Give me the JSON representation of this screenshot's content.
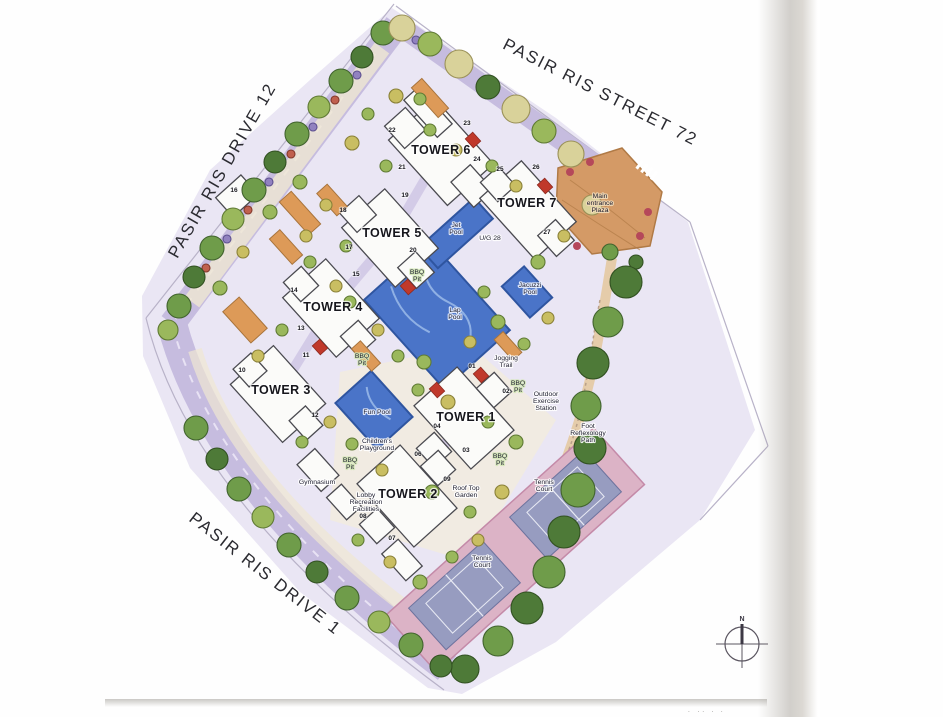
{
  "map": {
    "streets": [
      {
        "name": "PASIR RIS DRIVE 12",
        "x": 227,
        "y": 173,
        "angle": -60
      },
      {
        "name": "PASIR RIS STREET 72",
        "x": 598,
        "y": 97,
        "angle": 27
      },
      {
        "name": "PASIR RIS DRIVE 1",
        "x": 262,
        "y": 578,
        "angle": 38
      }
    ],
    "towers": [
      {
        "name": "TOWER 1",
        "x": 466,
        "y": 421
      },
      {
        "name": "TOWER 2",
        "x": 408,
        "y": 498
      },
      {
        "name": "TOWER 3",
        "x": 281,
        "y": 394
      },
      {
        "name": "TOWER 4",
        "x": 333,
        "y": 311
      },
      {
        "name": "TOWER 5",
        "x": 392,
        "y": 237
      },
      {
        "name": "TOWER 6",
        "x": 441,
        "y": 154
      },
      {
        "name": "TOWER 7",
        "x": 527,
        "y": 207
      }
    ],
    "amenities": [
      {
        "lines": [
          "Main",
          "entrance",
          "Plaza"
        ],
        "x": 600,
        "y": 198,
        "tint": "plaza"
      },
      {
        "lines": [
          "Jet",
          "Pool"
        ],
        "x": 456,
        "y": 227,
        "tint": "water"
      },
      {
        "lines": [
          "U/G 28"
        ],
        "x": 490,
        "y": 240,
        "tint": "plain"
      },
      {
        "lines": [
          "Lap",
          "Pool"
        ],
        "x": 455,
        "y": 312,
        "tint": "water"
      },
      {
        "lines": [
          "Jacuzzi",
          "Pool"
        ],
        "x": 530,
        "y": 287,
        "tint": "water"
      },
      {
        "lines": [
          "Fun Pool"
        ],
        "x": 377,
        "y": 414,
        "tint": "water"
      },
      {
        "lines": [
          "BBQ",
          "Pit"
        ],
        "x": 417,
        "y": 274,
        "tint": "green"
      },
      {
        "lines": [
          "BBQ",
          "Pit"
        ],
        "x": 362,
        "y": 358,
        "tint": "green"
      },
      {
        "lines": [
          "BBQ",
          "Pit"
        ],
        "x": 518,
        "y": 385,
        "tint": "green"
      },
      {
        "lines": [
          "BBQ",
          "Pit"
        ],
        "x": 500,
        "y": 458,
        "tint": "green"
      },
      {
        "lines": [
          "BBQ",
          "Pit"
        ],
        "x": 350,
        "y": 462,
        "tint": "green"
      },
      {
        "lines": [
          "Jogging",
          "Trail"
        ],
        "x": 506,
        "y": 360,
        "tint": "plain"
      },
      {
        "lines": [
          "Outdoor",
          "Exercise",
          "Station"
        ],
        "x": 546,
        "y": 396,
        "tint": "plain"
      },
      {
        "lines": [
          "Foot",
          "Reflexology",
          "Path"
        ],
        "x": 588,
        "y": 428,
        "tint": "plain"
      },
      {
        "lines": [
          "Tennis",
          "Court"
        ],
        "x": 544,
        "y": 484,
        "tint": "plain"
      },
      {
        "lines": [
          "Tennis",
          "Court"
        ],
        "x": 482,
        "y": 560,
        "tint": "plain"
      },
      {
        "lines": [
          "Roof Top",
          "Garden"
        ],
        "x": 466,
        "y": 490,
        "tint": "plain"
      },
      {
        "lines": [
          "Children's",
          "Playground"
        ],
        "x": 377,
        "y": 443,
        "tint": "plain"
      },
      {
        "lines": [
          "Gymnasium"
        ],
        "x": 317,
        "y": 484,
        "tint": "plain"
      },
      {
        "lines": [
          "Lobby",
          "Recreation",
          "Facilities"
        ],
        "x": 366,
        "y": 497,
        "tint": "plain"
      }
    ],
    "unit_numbers": [
      {
        "n": "01",
        "x": 472,
        "y": 368
      },
      {
        "n": "02",
        "x": 506,
        "y": 393
      },
      {
        "n": "03",
        "x": 466,
        "y": 452
      },
      {
        "n": "04",
        "x": 437,
        "y": 428
      },
      {
        "n": "06",
        "x": 418,
        "y": 456
      },
      {
        "n": "07",
        "x": 392,
        "y": 540
      },
      {
        "n": "08",
        "x": 363,
        "y": 518
      },
      {
        "n": "09",
        "x": 447,
        "y": 481
      },
      {
        "n": "10",
        "x": 242,
        "y": 372
      },
      {
        "n": "11",
        "x": 306,
        "y": 357
      },
      {
        "n": "12",
        "x": 315,
        "y": 417
      },
      {
        "n": "13",
        "x": 301,
        "y": 330
      },
      {
        "n": "14",
        "x": 294,
        "y": 292
      },
      {
        "n": "15",
        "x": 356,
        "y": 276
      },
      {
        "n": "16",
        "x": 234,
        "y": 192
      },
      {
        "n": "17",
        "x": 349,
        "y": 249
      },
      {
        "n": "18",
        "x": 343,
        "y": 212
      },
      {
        "n": "19",
        "x": 405,
        "y": 197
      },
      {
        "n": "20",
        "x": 413,
        "y": 252
      },
      {
        "n": "21",
        "x": 402,
        "y": 169
      },
      {
        "n": "22",
        "x": 392,
        "y": 132
      },
      {
        "n": "23",
        "x": 467,
        "y": 125
      },
      {
        "n": "24",
        "x": 477,
        "y": 161
      },
      {
        "n": "25",
        "x": 500,
        "y": 171
      },
      {
        "n": "26",
        "x": 536,
        "y": 169
      },
      {
        "n": "27",
        "x": 547,
        "y": 234
      }
    ],
    "compass": {
      "north_label": "N"
    },
    "edge_caption": "· ·· ·   ·"
  },
  "colors": {
    "pool_blue": "#4a74c8",
    "pool_edge": "#2f55a0",
    "pool_swirl": "#8fb0e4",
    "road_lavender": "#c6bcdf",
    "ground_wash": "#eae6f4",
    "cream": "#efe7d2",
    "courtyard_cream": "#f3edda",
    "court_slate": "#979cc0",
    "court_pink": "#dcb3c6",
    "plaza_tan": "#d49a66",
    "plaza_edge": "#b07a46",
    "planter_orange": "#dd9a58",
    "accent_red": "#c0392b",
    "building_fill": "#fbfbf9",
    "building_edge": "#4a4a50",
    "edge_line": "#b8b2c8"
  }
}
